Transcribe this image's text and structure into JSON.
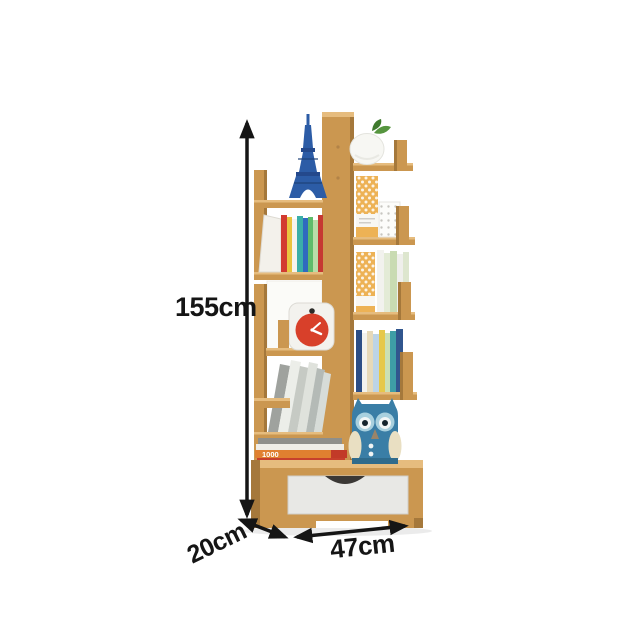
{
  "page": {
    "background": "#ffffff",
    "description": "Product photo of a tree-shaped wooden bookshelf with bottom drawer, annotated with dimension arrows"
  },
  "annotations": {
    "height_label": "155cm",
    "depth_label": "20cm",
    "width_label": "47cm"
  },
  "decor": {
    "book_stack_spine_text": "1000",
    "items": [
      "eiffel-tower-figurine",
      "white-vase-with-plant",
      "honeycomb-storage-boxes",
      "dotted-storage-box",
      "cuckoo-clock",
      "colorful-book-row",
      "white-green-book-row",
      "leaning-grey-books",
      "stacked-books",
      "owl-plush",
      "fabric-drawer"
    ]
  },
  "colors": {
    "wood": "#CB9750",
    "wood_light": "#E6BC7E",
    "wood_dark": "#A5783B",
    "wood_deep": "#8A6330",
    "arrow": "#151515",
    "clock_red": "#D8402A",
    "tower_blue": "#2C5CA6",
    "owl_teal": "#3A7EA6",
    "owl_light": "#A8D0DE",
    "drawer_fabric": "#E8E8E5",
    "honeycomb_orange": "#EDB255",
    "plant_green": "#56953F"
  }
}
